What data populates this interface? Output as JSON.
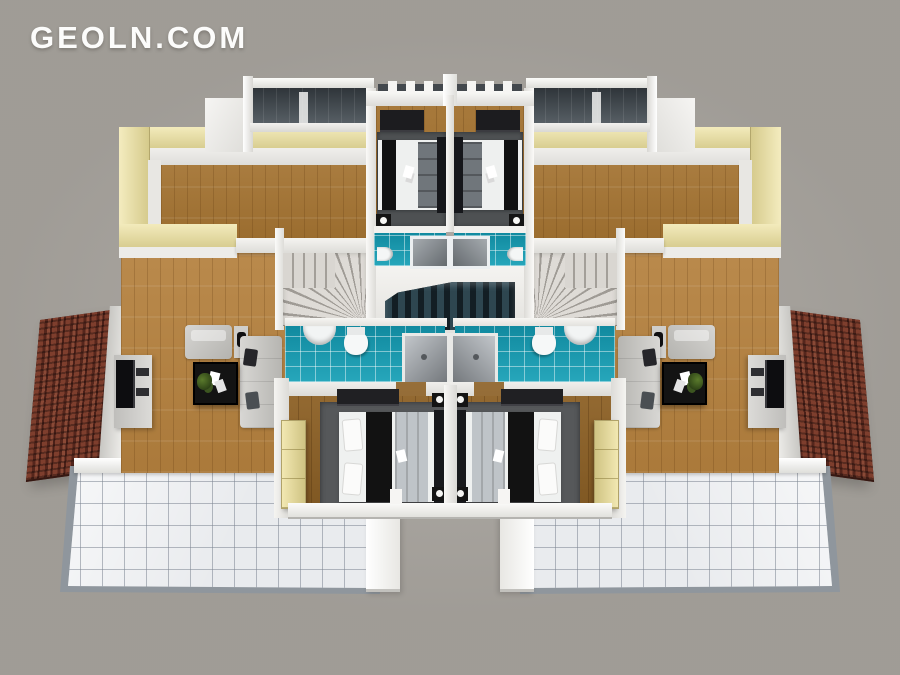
{
  "watermark": {
    "text": "GEOLN.COM"
  },
  "palette": {
    "background": "#a8a49e",
    "wall_white": "#f4f3f0",
    "wall_beige": "#ece3ac",
    "floor_wood": "#b5813e",
    "floor_wood_dark": "#8d6126",
    "bathroom_teal": "#149fb5",
    "balcony_slate": "#454c52",
    "roof_red": "#6b3226",
    "terrace_tile": "#e9ebee",
    "rug_gray": "#56585a",
    "sofa_gray": "#c9c8c5",
    "furniture_black": "#171717",
    "stair_gray": "#d8d5d0",
    "stair_dark": "#22313a",
    "wardrobe_cream": "#efe5ad"
  }
}
